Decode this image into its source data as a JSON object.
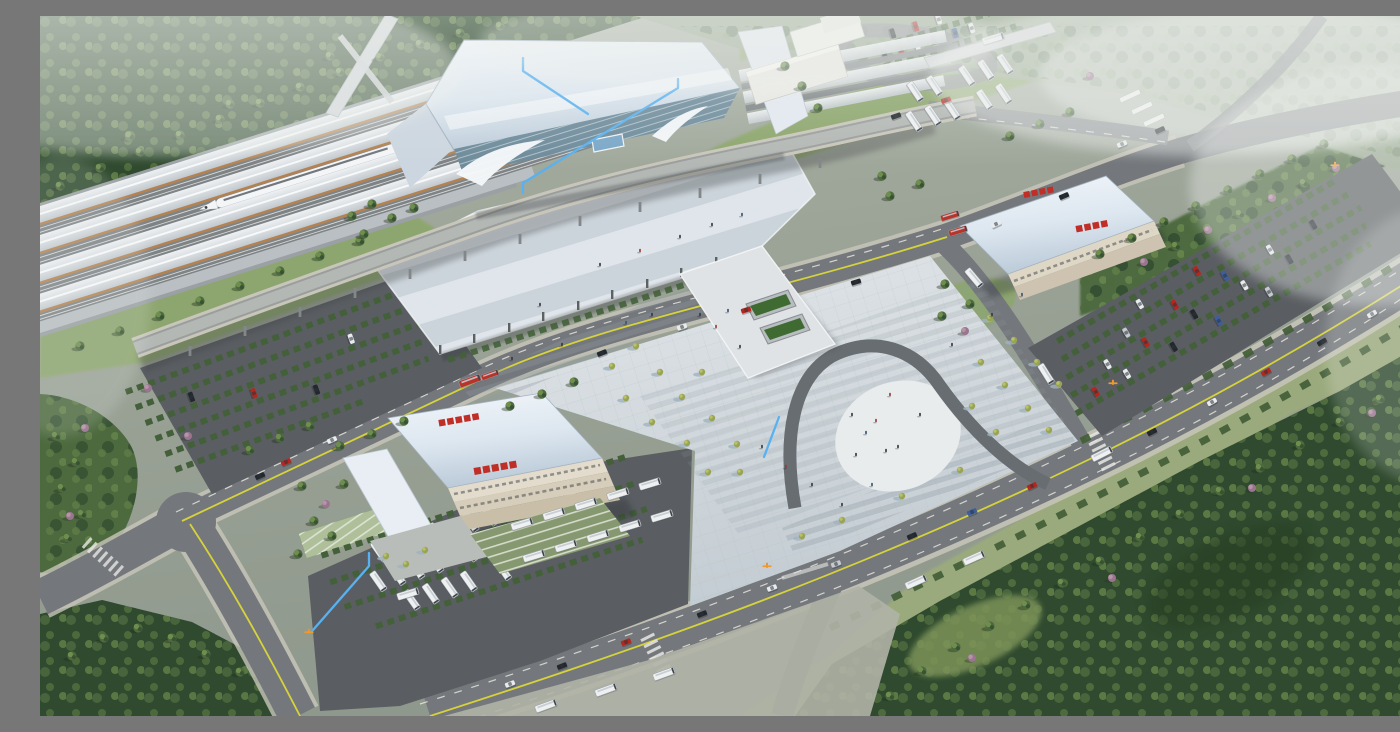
{
  "scene": {
    "title": "Aerial rendering of a high-speed railway station complex",
    "description": "Photorealistic bird's-eye 3D architectural rendering: a high-speed rail station with long platform canopies and a white bullet train at upper left, a large pale-blue station hall with curved glass entrances, an elevated drop-off viaduct, a vast striped concourse canopy, a central pedestrian plaza with a horseshoe-shaped path and fan steps, two bus-terminal buildings with red rooftop signs, bus depots full of white coaches, tree-lined parking lots, wide roads with yellow center lines and traffic, dense forests and morning haze. Light-blue annotation polylines with small orange gate markers overlay the drawing.",
    "view": "oblique aerial, hazy daylight"
  },
  "palette": {
    "base1": "#aab1a4",
    "base2": "#8f988c",
    "forestDark": "#2f4a2e",
    "forestMid": "#4d6a3f",
    "forestLight": "#71904f",
    "haze": "#97a68f",
    "lawn": "#8ba668",
    "meadow": "#9cab7c",
    "hedge": "#44603a",
    "bloomPink": "#9a7590",
    "road": "#74787c",
    "roadLight": "#888c90",
    "asphalt": "#5a5e62",
    "sidewalk": "#c8c6ba",
    "laneYellow": "#d6d23c",
    "laneWhite": "#eceae2",
    "plazaA": "#e0e4e7",
    "plazaB": "#c4cdd3",
    "canopyA": "#dfe5ea",
    "canopyB": "#cbd4da",
    "roofHi": "#f2f6fa",
    "roofLo": "#bccbd9",
    "annexRoof": "#ccd6e0",
    "glass": "#6e8b9b",
    "trackTrim": "#b5824f",
    "trackBed": "#7e8386",
    "train": "#f3f5f7",
    "signRed": "#bf2f27",
    "annBlue": "#58b1f0",
    "gateOrange": "#ef9a2e",
    "busWhite": "#eef0f2",
    "busRed": "#b8342b",
    "carRed": "#b5271e",
    "carWhite": "#e9ecee",
    "carDark": "#23282d",
    "carBlue": "#3c5e9e",
    "carSilver": "#c4cacd",
    "baysGreen": "#86986f",
    "escGreen": "#3f6b33",
    "uPath": "#686d71",
    "uInner": "#e9eced",
    "fog": "#eef1ee"
  },
  "objects": {
    "tracks": "railway platforms with canopies",
    "train": "white high-speed train",
    "footbridge": "pedestrian bridge over tracks",
    "overpass": "road overpass crossing rail yard",
    "hall": "main station hall with glass facade",
    "viaduct": "elevated drop-off viaduct",
    "canopy": "striped concourse canopy",
    "deck": "pedestrian deck with escalators to underpass",
    "plaza": "central station plaza",
    "upath": "horseshoe-shaped plaza path with fan steps",
    "terminalWest": "west bus terminal with red roof signs",
    "terminalEast": "east coach terminal with red roof signs",
    "busDepot": "bus depot parking",
    "parkingWest": "west car park",
    "parkingEast": "east car park",
    "parkingNorth": "north car park loop",
    "avenue": "southern avenue with yellow center line",
    "frontRoad": "station front road",
    "forests": "surrounding woodland and haze",
    "annotations": "light-blue annotation leader lines",
    "gates": "orange entrance gate markers"
  },
  "counts": {
    "trains": 1,
    "buses_white": 45,
    "buses_red": 4,
    "cars": 52,
    "annotation_polylines": 4,
    "gate_markers": 4,
    "red_roof_signs": 4
  }
}
